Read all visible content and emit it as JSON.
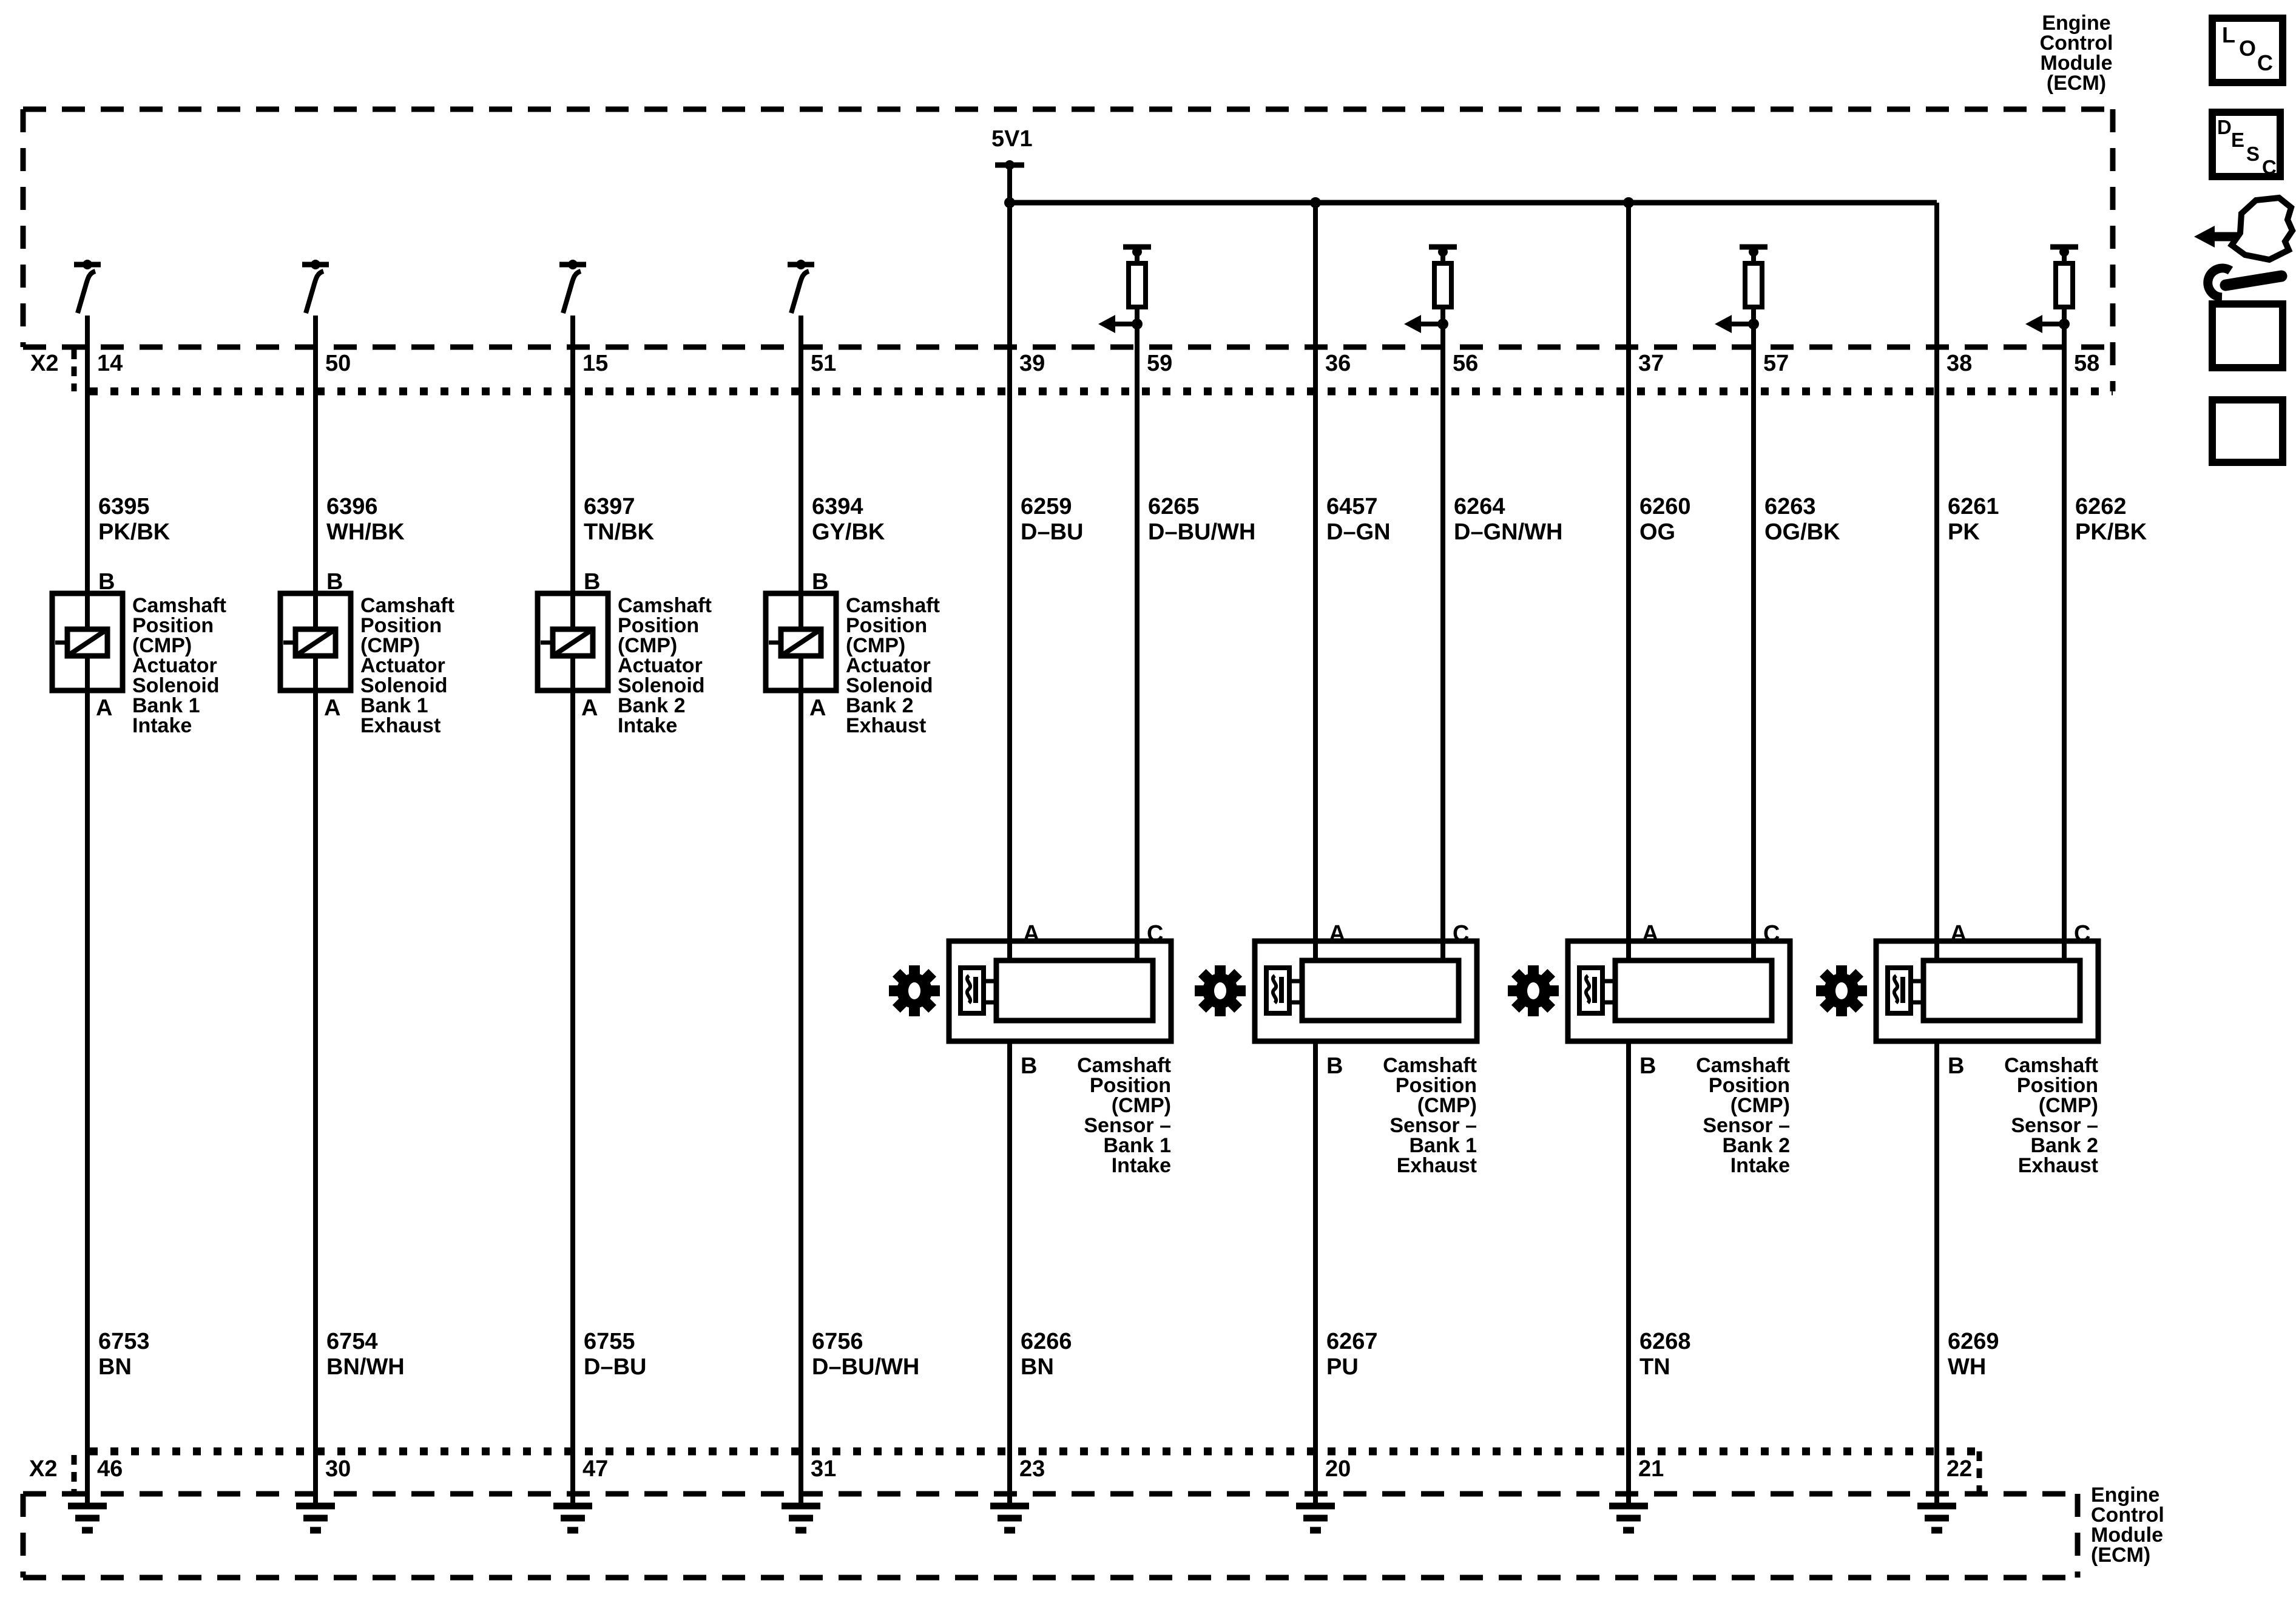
{
  "ecm": {
    "top_label": "Engine\nControl\nModule\n(ECM)",
    "bottom_label": "Engine\nControl\nModule\n(ECM)"
  },
  "power": {
    "reference_label": "5V1"
  },
  "connector_top": {
    "name": "X2",
    "pins": [
      "14",
      "50",
      "15",
      "51",
      "39",
      "59",
      "36",
      "56",
      "37",
      "57",
      "38",
      "58"
    ]
  },
  "connector_bottom": {
    "name": "X2",
    "pins": [
      "46",
      "30",
      "47",
      "31",
      "23",
      "20",
      "21",
      "22"
    ]
  },
  "wires_top": [
    {
      "id": "6395",
      "color": "PK/BK"
    },
    {
      "id": "6396",
      "color": "WH/BK"
    },
    {
      "id": "6397",
      "color": "TN/BK"
    },
    {
      "id": "6394",
      "color": "GY/BK"
    },
    {
      "id": "6259",
      "color": "D–BU"
    },
    {
      "id": "6265",
      "color": "D–BU/WH"
    },
    {
      "id": "6457",
      "color": "D–GN"
    },
    {
      "id": "6264",
      "color": "D–GN/WH"
    },
    {
      "id": "6260",
      "color": "OG"
    },
    {
      "id": "6263",
      "color": "OG/BK"
    },
    {
      "id": "6261",
      "color": "PK"
    },
    {
      "id": "6262",
      "color": "PK/BK"
    }
  ],
  "wires_bottom": [
    {
      "id": "6753",
      "color": "BN"
    },
    {
      "id": "6754",
      "color": "BN/WH"
    },
    {
      "id": "6755",
      "color": "D–BU"
    },
    {
      "id": "6756",
      "color": "D–BU/WH"
    },
    {
      "id": "6266",
      "color": "BN"
    },
    {
      "id": "6267",
      "color": "PU"
    },
    {
      "id": "6268",
      "color": "TN"
    },
    {
      "id": "6269",
      "color": "WH"
    }
  ],
  "solenoids": [
    {
      "pin_top": "B",
      "pin_bottom": "A",
      "name": "Camshaft\nPosition\n(CMP)\nActuator\nSolenoid\nBank 1\nIntake"
    },
    {
      "pin_top": "B",
      "pin_bottom": "A",
      "name": "Camshaft\nPosition\n(CMP)\nActuator\nSolenoid\nBank 1\nExhaust"
    },
    {
      "pin_top": "B",
      "pin_bottom": "A",
      "name": "Camshaft\nPosition\n(CMP)\nActuator\nSolenoid\nBank 2\nIntake"
    },
    {
      "pin_top": "B",
      "pin_bottom": "A",
      "name": "Camshaft\nPosition\n(CMP)\nActuator\nSolenoid\nBank 2\nExhaust"
    }
  ],
  "sensors": [
    {
      "pin_left": "A",
      "pin_right": "C",
      "pin_bottom": "B",
      "name": "Camshaft\nPosition\n(CMP)\nSensor –\nBank 1\nIntake"
    },
    {
      "pin_left": "A",
      "pin_right": "C",
      "pin_bottom": "B",
      "name": "Camshaft\nPosition\n(CMP)\nSensor –\nBank 1\nExhaust"
    },
    {
      "pin_left": "A",
      "pin_right": "C",
      "pin_bottom": "B",
      "name": "Camshaft\nPosition\n(CMP)\nSensor –\nBank 2\nIntake"
    },
    {
      "pin_left": "A",
      "pin_right": "C",
      "pin_bottom": "B",
      "name": "Camshaft\nPosition\n(CMP)\nSensor –\nBank 2\nExhaust"
    }
  ],
  "sidebar": {
    "loc": [
      "L",
      "O",
      "C"
    ],
    "desc": [
      "D",
      "E",
      "S",
      "C"
    ]
  },
  "colors": {
    "ink": "#000000",
    "paper": "#ffffff"
  }
}
